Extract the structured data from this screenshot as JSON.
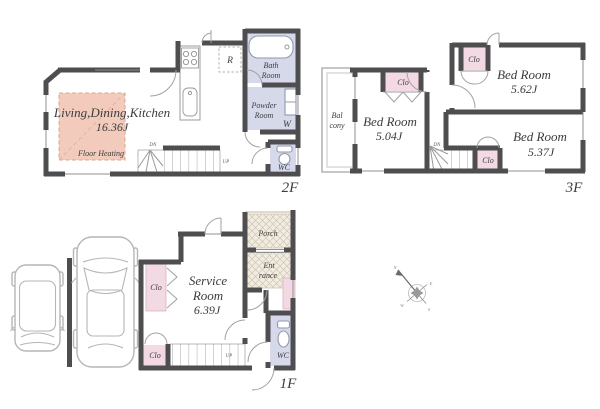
{
  "colors": {
    "wall": "#4e4d4f",
    "wet_room_fill": "#d6d9e9",
    "closet_fill": "#f3d9e3",
    "floor_heating_fill": "#f2cbbd",
    "hatch_fill": "#f1ece2",
    "car_outline": "#b6b6b6"
  },
  "floor_2f": {
    "label": "2F",
    "ldk_name": "Living,Dining,Kitchen",
    "ldk_size": "16.36J",
    "floor_heating": "Floor Heating",
    "refrigerator": "R",
    "bath_line1": "Bath",
    "bath_line2": "Room",
    "powder_line1": "Powder",
    "powder_line2": "Room",
    "washer": "W",
    "wc": "WC",
    "stairs_down": "DN",
    "stairs_up": "UP"
  },
  "floor_3f": {
    "label": "3F",
    "balcony_line1": "Bal",
    "balcony_line2": "cony",
    "closet": "Clo",
    "stairs_down": "DN",
    "bedrooms": [
      {
        "name": "Bed Room",
        "size": "5.04J"
      },
      {
        "name": "Bed Room",
        "size": "5.62J"
      },
      {
        "name": "Bed Room",
        "size": "5.37J"
      }
    ]
  },
  "floor_1f": {
    "label": "1F",
    "service_line1": "Service",
    "service_line2": "Room",
    "service_size": "6.39J",
    "porch": "Porch",
    "entrance_line1": "Ent",
    "entrance_line2": "rance",
    "closet": "Clo",
    "wc": "WC",
    "stairs_up": "UP"
  },
  "compass": {
    "n": "N",
    "e": "E",
    "s": "S",
    "w": "W"
  }
}
